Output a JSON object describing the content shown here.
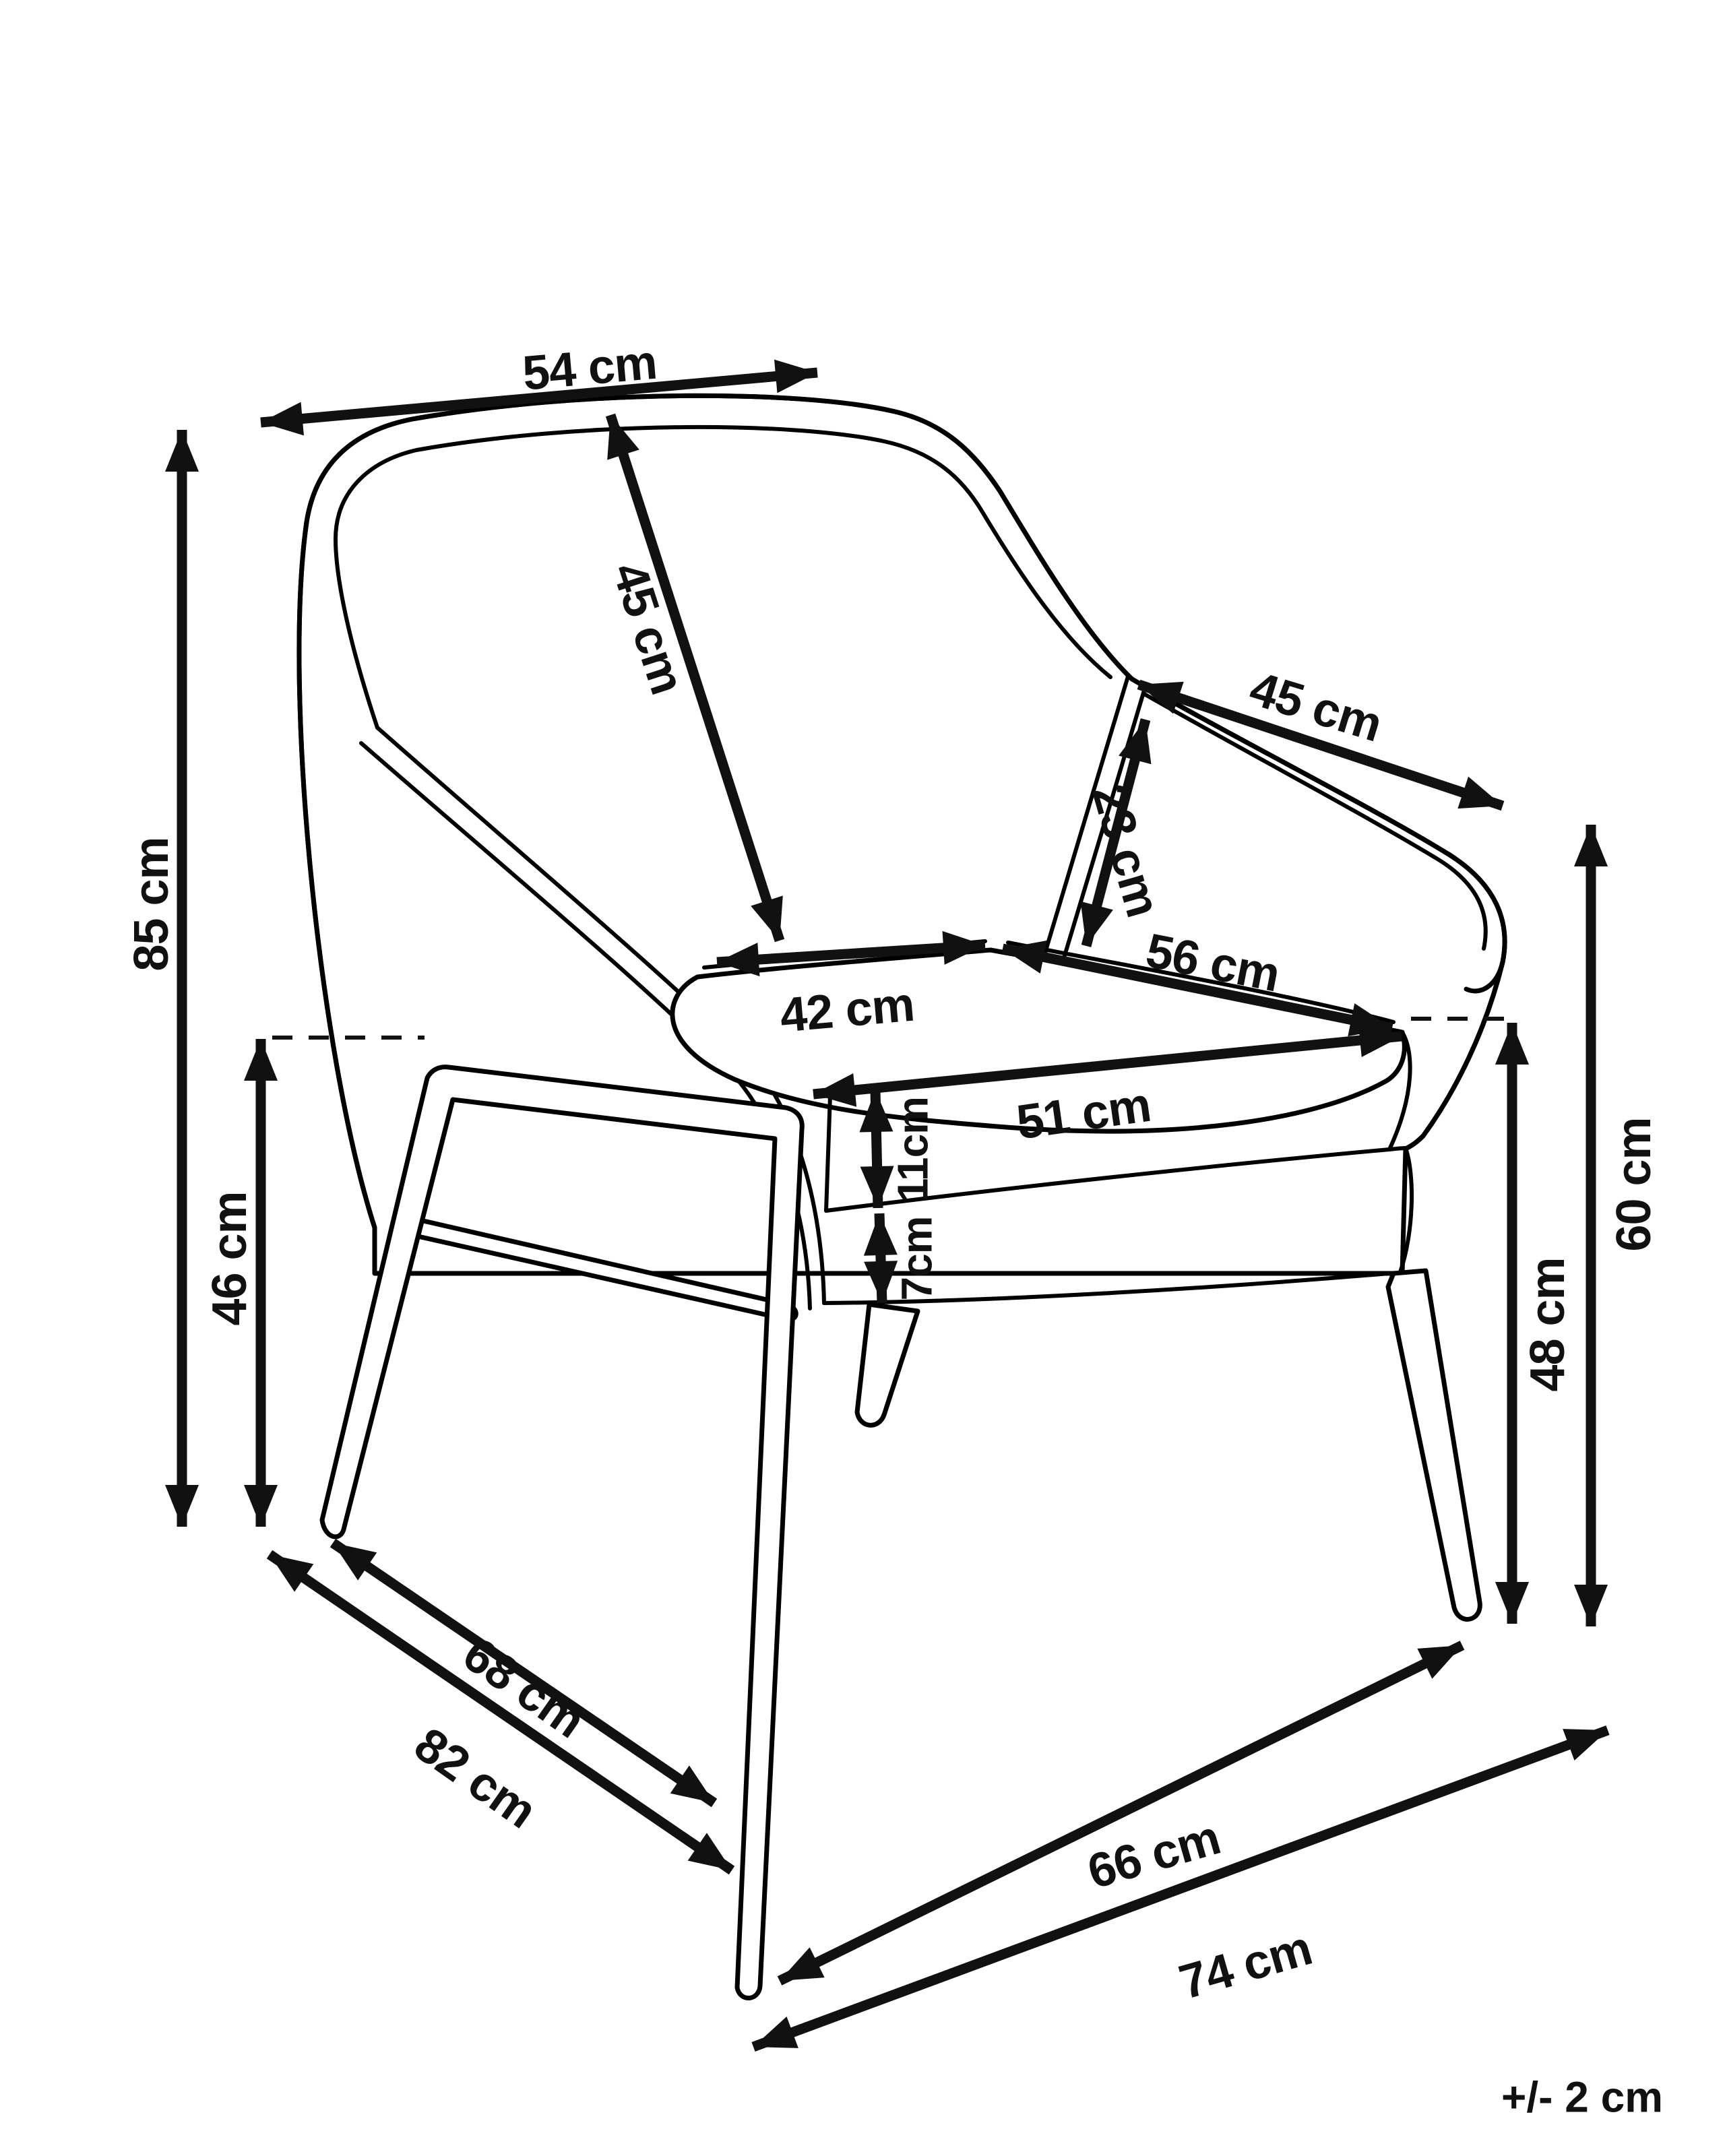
{
  "diagram": {
    "type": "furniture-dimension-drawing",
    "subject": "armchair line drawing, three-quarter view",
    "unit": "cm",
    "line_color": "#000000",
    "background_color": "#ffffff",
    "tolerance_note": "+/- 2 cm",
    "dimensions": {
      "top_width": "54 cm",
      "backrest_diagonal": "45 cm",
      "armrest_length": "45 cm",
      "armrest_height_above_seat": "23 cm",
      "overall_height": "85 cm",
      "seat_height": "46 cm",
      "seat_depth_left": "42 cm",
      "seat_width_right": "56 cm",
      "seat_front_width": "51 cm",
      "seat_cushion_thickness": "11cm",
      "base_frame_thickness": "7cm",
      "right_height_inner": "48 cm",
      "right_height_outer": "60 cm",
      "floor_depth_inner": "68 cm",
      "floor_depth_outer": "82 cm",
      "floor_width_inner": "66 cm",
      "floor_width_outer": "74 cm"
    }
  }
}
